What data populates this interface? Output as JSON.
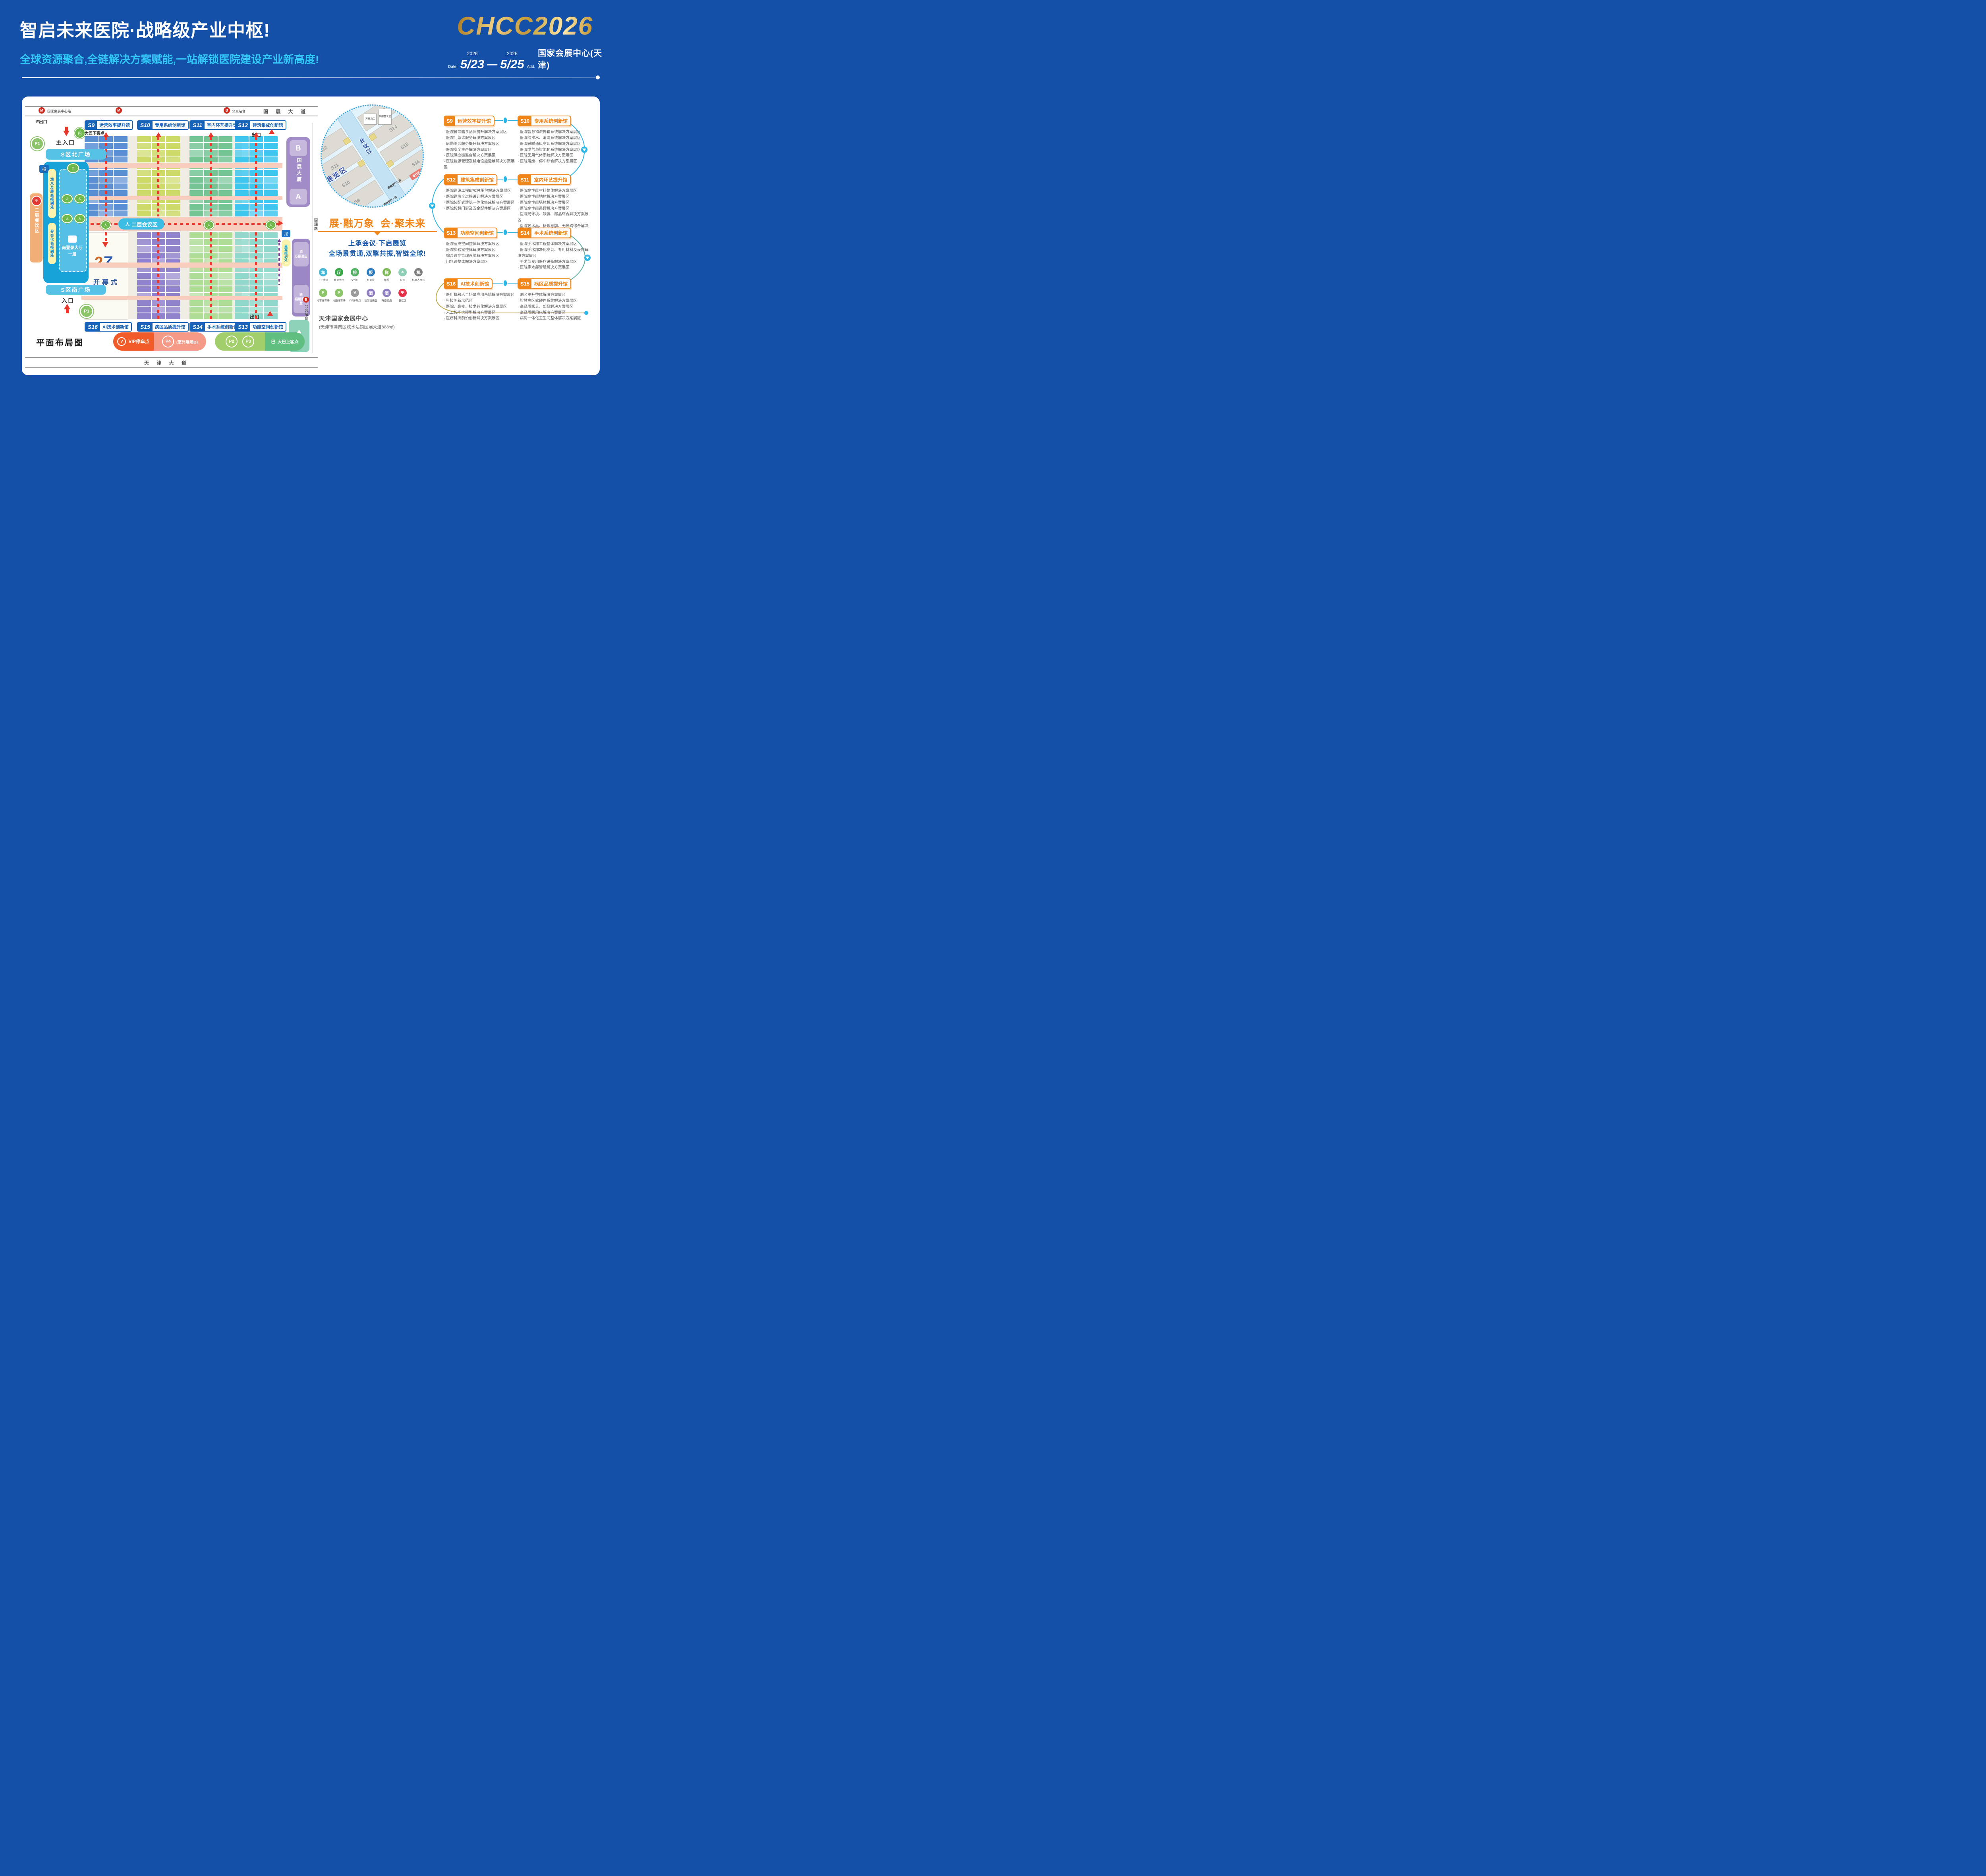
{
  "header": {
    "title": "智启未来医院·战略级产业中枢!",
    "subtitle": "全球资源聚合,全链解决方案赋能,一站解锁医院建设产业新高度!",
    "logo": "CHCC2026",
    "date_label": "Date.",
    "year1": "2026",
    "date1": "5/23",
    "dash": "—",
    "year2": "2026",
    "date2": "5/25",
    "addr_label": "Add.",
    "venue_short": "国家会展中心(天津)"
  },
  "map": {
    "road_top": "国 展 大 道",
    "metro_station": "国家会展中心站",
    "bus_platform": "公交站台",
    "exit_e": "E出口",
    "exit_f": "F出口",
    "exit": "出口",
    "halls_top": [
      {
        "id": "S9",
        "name": "运营效率提升馆",
        "color": "#5b8fd3"
      },
      {
        "id": "S10",
        "name": "专用系统创新馆",
        "color": "#cdda68"
      },
      {
        "id": "S11",
        "name": "室内环艺提升馆",
        "color": "#74c494"
      },
      {
        "id": "S12",
        "name": "建筑集成创新馆",
        "color": "#3ec6ee"
      }
    ],
    "halls_bottom": [
      {
        "id": "S16",
        "name": "AI技术创新馆",
        "color": "#fcfbf3"
      },
      {
        "id": "S15",
        "name": "病区品质提升馆",
        "color": "#9183cb"
      },
      {
        "id": "S14",
        "name": "手术系统创新馆",
        "color": "#aedd96"
      },
      {
        "id": "S13",
        "name": "功能空间创新馆",
        "color": "#8fd8cb"
      }
    ],
    "main_entrance": "主入口",
    "bus_drop": "大巴下客点",
    "north_plaza": "S区北广场",
    "south_plaza": "S区南广场",
    "reg_visitor": "观众及展商报到处",
    "reg_delegate": "参会代表报到处",
    "south_hall_line1": "南登录大厅",
    "south_hall_line2": "一层",
    "dining_strip": "二层餐饮区",
    "meeting_zone": "二层会议区",
    "entrance": "入口",
    "p1": "P1",
    "opening_num": "27",
    "opening_th": "TH",
    "opening": "开幕式",
    "tower": "国展大厦",
    "tower_b": "B",
    "tower_a": "A",
    "road_right": "国瑞路",
    "guest_reg": "嘉宾报到处",
    "hotel_marriott": "万豪酒店",
    "hotel_sheraton": "福朋喜来登",
    "park": "公园",
    "bus_platform2": "公交站台",
    "road_bottom": "天 津 大 道",
    "plan_title": "平面布局图",
    "legend_vip": "VIP停车点",
    "legend_p4": "P4",
    "legend_p4_note": "(室外展场B)",
    "legend_p2": "P2",
    "legend_p3": "P3",
    "legend_bus": "大巴上客点"
  },
  "right": {
    "bubble": {
      "expo": "展览区",
      "meeting": "会议区",
      "main_entrance": "主入口",
      "hall_l2": "南登录厅二层",
      "hall_l1": "南登录厅一层",
      "dining": "餐饮区",
      "marriott": "万豪酒店",
      "sheraton": "福朋喜来登",
      "halls_left": [
        "S12",
        "S11",
        "S10",
        "S9"
      ],
      "halls_right": [
        "S13",
        "S14",
        "S15",
        "S16"
      ]
    },
    "slogan_left": "展·融万象",
    "slogan_right": "会·聚未来",
    "tagline1": "上承会议·下启展览",
    "tagline2": "全场景贯通,双擎共振,智链全球!",
    "legend_row1": [
      {
        "label": "上下客区",
        "color": "#49b8d8",
        "glyph": "车",
        "icon": "passenger-zone-icon"
      },
      {
        "label": "登录大厅",
        "color": "#3aa648",
        "glyph": "厅",
        "icon": "login-hall-icon"
      },
      {
        "label": "安检区",
        "color": "#51b163",
        "glyph": "检",
        "icon": "security-check-icon"
      },
      {
        "label": "报到处",
        "color": "#2878be",
        "glyph": "报",
        "icon": "registration-icon"
      },
      {
        "label": "阶梯",
        "color": "#7cb854",
        "glyph": "梯",
        "icon": "stairs-icon"
      },
      {
        "label": "公园",
        "color": "#8fd0b6",
        "glyph": "♣",
        "icon": "park-icon"
      },
      {
        "label": "机器人展区",
        "color": "#7d7d7d",
        "glyph": "机",
        "icon": "robot-zone-icon"
      }
    ],
    "legend_row2": [
      {
        "label": "地下停车场",
        "color": "#8cc46a",
        "glyph": "P",
        "icon": "underground-parking-icon"
      },
      {
        "label": "地面停车场",
        "color": "#8cc46a",
        "glyph": "P",
        "icon": "ground-parking-icon"
      },
      {
        "label": "VIP停车点",
        "color": "#9a9a9a",
        "glyph": "V",
        "icon": "vip-parking-icon"
      },
      {
        "label": "福朋喜来登",
        "color": "#8f7ec0",
        "glyph": "酒",
        "icon": "sheraton-hotel-icon"
      },
      {
        "label": "万豪酒店",
        "color": "#8f7ec0",
        "glyph": "酒",
        "icon": "marriott-hotel-icon"
      },
      {
        "label": "餐饮区",
        "color": "#e8334a",
        "glyph": "Ψ",
        "icon": "dining-icon"
      }
    ],
    "venue": "天津国家会展中心",
    "venue_addr": "(天津市津南区咸水沽镇国展大道888号)",
    "groups": [
      {
        "left": {
          "id": "S9",
          "name": "运营效率提升馆",
          "items": [
            "医院餐饮膳食品质提升解决方案展区",
            "医院门急诊服务解决方案展区",
            "后勤综合服务提升解决方案展区",
            "医院安全生产解决方案展区",
            "医院供应链整合解决方案展区",
            "医院能源管理及机电设施运维解决方案展区"
          ]
        },
        "right": {
          "id": "S10",
          "name": "专用系统创新馆",
          "items": [
            "医院智慧物流传输系统解决方案展区",
            "医院给排水、消防系统解决方案展区",
            "医院采暖通风空调系统解决方案展区",
            "医院电气与智能化系统解决方案展区",
            "医院医用气体系统解决方案展区",
            "医院污废、停车综合解决方案展区"
          ]
        }
      },
      {
        "left": {
          "id": "S12",
          "name": "建筑集成创新馆",
          "items": [
            "医院建设工程EPC总承包解决方案展区",
            "医院建筑全过程设计解决方案展区",
            "医院装配式建筑一体化集成解决方案展区",
            "医院智慧门窗及五金配件解决方案展区"
          ]
        },
        "right": {
          "id": "S11",
          "name": "室内环艺提升馆",
          "items": [
            "医院高性能材料整体解决方案展区",
            "医院高性能地材解决方案展区",
            "医院高性能墙材解决方案展区",
            "医院高性能吊顶解决方案展区",
            "医院光环境、软装、部品综合解决方案展区",
            "医院艺术品、标识标牌、无障碍综合解决方案展区"
          ]
        }
      },
      {
        "left": {
          "id": "S13",
          "name": "功能空间创新馆",
          "items": [
            "医院医技空间整体解决方案展区",
            "医院实验室整体解决方案展区",
            "综合诊疗管理系统解决方案展区",
            "门急诊整体解决方案展区"
          ]
        },
        "right": {
          "id": "S14",
          "name": "手术系统创新馆",
          "items": [
            "医院手术部工程整体解决方案展区",
            "医院手术部净化空调、专用材料及设施解决方案展区",
            "手术部专用医疗设备解决方案展区",
            "医院手术部智慧解决方案展区"
          ]
        }
      },
      {
        "left": {
          "id": "S16",
          "name": "AI技术创新馆",
          "items": [
            "医用机器人全场景应用系统解决方案展区",
            "科技创新示范区",
            "医院、高校、技术转化解决方案展区",
            "人工智能大模型解决方案展区",
            "医疗科技前沿创新解决方案展区"
          ]
        },
        "right": {
          "id": "S15",
          "name": "病区品质提升馆",
          "items": [
            "病区提升整体解决方案展区",
            "智慧病区软硬件系统解决方案展区",
            "高品质家具、部品解决方案展区",
            "高品质医用床解决方案展区",
            "病房一体化卫生间整体解决方案展区"
          ]
        }
      }
    ]
  }
}
